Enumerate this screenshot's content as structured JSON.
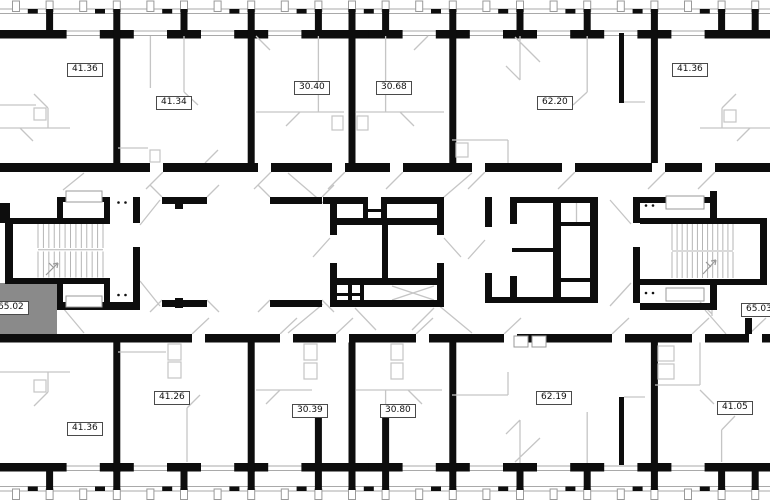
{
  "colors": {
    "background": "#ffffff",
    "wall": "#0d0d0d",
    "partition": "#c5c5c5",
    "facade_line": "#a9a9a9",
    "highlight": "#8a8a8a",
    "label_border": "#4a4a4a",
    "label_text": "#111111"
  },
  "floor_plan": {
    "selected_unit_area": "65.02",
    "units": [
      {
        "id": "top-1",
        "area": "41.36",
        "band": "top",
        "label_left": 67,
        "label_top": 63,
        "highlighted": false
      },
      {
        "id": "top-2",
        "area": "41.34",
        "band": "top",
        "label_left": 156,
        "label_top": 96,
        "highlighted": false
      },
      {
        "id": "top-3",
        "area": "30.40",
        "band": "top",
        "label_left": 294,
        "label_top": 81,
        "highlighted": false
      },
      {
        "id": "top-4",
        "area": "30.68",
        "band": "top",
        "label_left": 376,
        "label_top": 81,
        "highlighted": false
      },
      {
        "id": "top-5",
        "area": "62.20",
        "band": "top",
        "label_left": 537,
        "label_top": 96,
        "highlighted": false
      },
      {
        "id": "top-6",
        "area": "41.36",
        "band": "top",
        "label_left": 672,
        "label_top": 63,
        "highlighted": false
      },
      {
        "id": "middle-left",
        "area": "65.02",
        "band": "middle",
        "label_left": -7,
        "label_top": 301,
        "highlighted": true
      },
      {
        "id": "middle-right",
        "area": "65.03",
        "band": "middle",
        "label_left": 741,
        "label_top": 303,
        "highlighted": false
      },
      {
        "id": "bottom-1",
        "area": "41.36",
        "band": "bottom",
        "label_left": 67,
        "label_top": 422,
        "highlighted": false
      },
      {
        "id": "bottom-2",
        "area": "41.26",
        "band": "bottom",
        "label_left": 154,
        "label_top": 391,
        "highlighted": false
      },
      {
        "id": "bottom-3",
        "area": "30.39",
        "band": "bottom",
        "label_left": 292,
        "label_top": 404,
        "highlighted": false
      },
      {
        "id": "bottom-4",
        "area": "30.80",
        "band": "bottom",
        "label_left": 380,
        "label_top": 404,
        "highlighted": false
      },
      {
        "id": "bottom-5",
        "area": "62.19",
        "band": "bottom",
        "label_left": 536,
        "label_top": 391,
        "highlighted": false
      },
      {
        "id": "bottom-6",
        "area": "41.05",
        "band": "bottom",
        "label_left": 717,
        "label_top": 401,
        "highlighted": false
      }
    ]
  }
}
